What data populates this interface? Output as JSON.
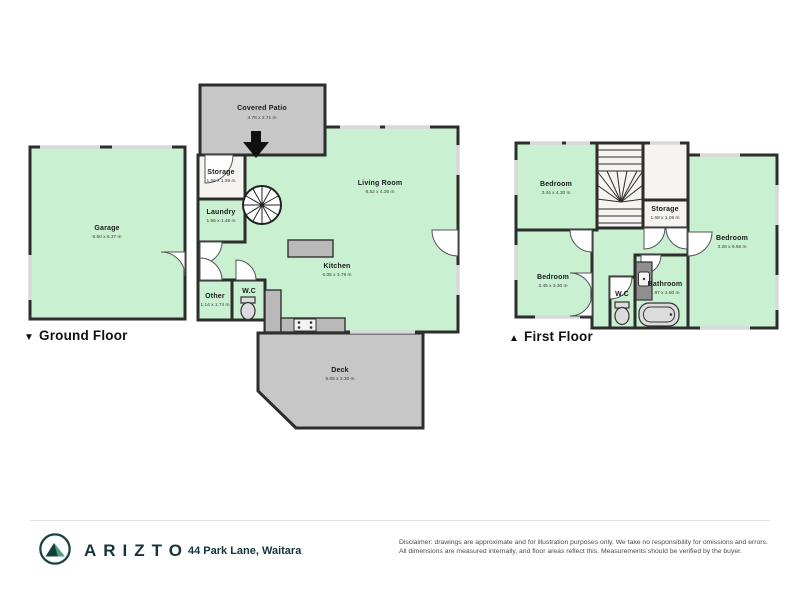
{
  "ground_floor": {
    "marker": "▼",
    "label": "Ground Floor",
    "rooms": {
      "covered_patio": {
        "name": "Covered Patio",
        "dims": "4.78 x 2.71 m"
      },
      "storage": {
        "name": "Storage",
        "dims": "1.56 x 1.59 m"
      },
      "laundry": {
        "name": "Laundry",
        "dims": "1.56 x 1.48 m"
      },
      "garage": {
        "name": "Garage",
        "dims": "6.50 x 6.37 m"
      },
      "living_room": {
        "name": "Living Room",
        "dims": "8.52 x 4.36 m"
      },
      "kitchen": {
        "name": "Kitchen",
        "dims": "6.05 x 3.79 m"
      },
      "other": {
        "name": "Other",
        "dims": "1.14 x 1.74 m"
      },
      "wc": {
        "name": "W.C"
      },
      "deck": {
        "name": "Deck",
        "dims": "6.05 x 3.30 m"
      }
    }
  },
  "first_floor": {
    "marker": "▲",
    "label": "First Floor",
    "rooms": {
      "bedroom_top_left": {
        "name": "Bedroom",
        "dims": "3.44 x 4.30 m"
      },
      "storage": {
        "name": "Storage",
        "dims": "1.68 x 1.05 m"
      },
      "bedroom_right": {
        "name": "Bedroom",
        "dims": "3.26 x 6.66 m"
      },
      "bedroom_bottom_left": {
        "name": "Bedroom",
        "dims": "3.45 x 3.30 m"
      },
      "wc": {
        "name": "W.C"
      },
      "bathroom": {
        "name": "Bathroom",
        "dims": "1.97 x 2.80 m"
      }
    }
  },
  "footer": {
    "brand": "ARIZTO",
    "address": "44 Park Lane, Waitara",
    "disclaimer_line1": "Disclaimer: drawings are approximate and for illustration purposes only. We take no responsibility for omissions and errors.",
    "disclaimer_line2": "All dimensions are measured internally, and floor areas reflect this. Measurements should be verified by the buyer."
  },
  "colors": {
    "room_fill": "#c9f0d0",
    "hard_surface_fill": "#c7c7c7",
    "wall": "#2d2d2d",
    "brand_dark": "#14333b",
    "logo_green": "#4e9d7c"
  }
}
